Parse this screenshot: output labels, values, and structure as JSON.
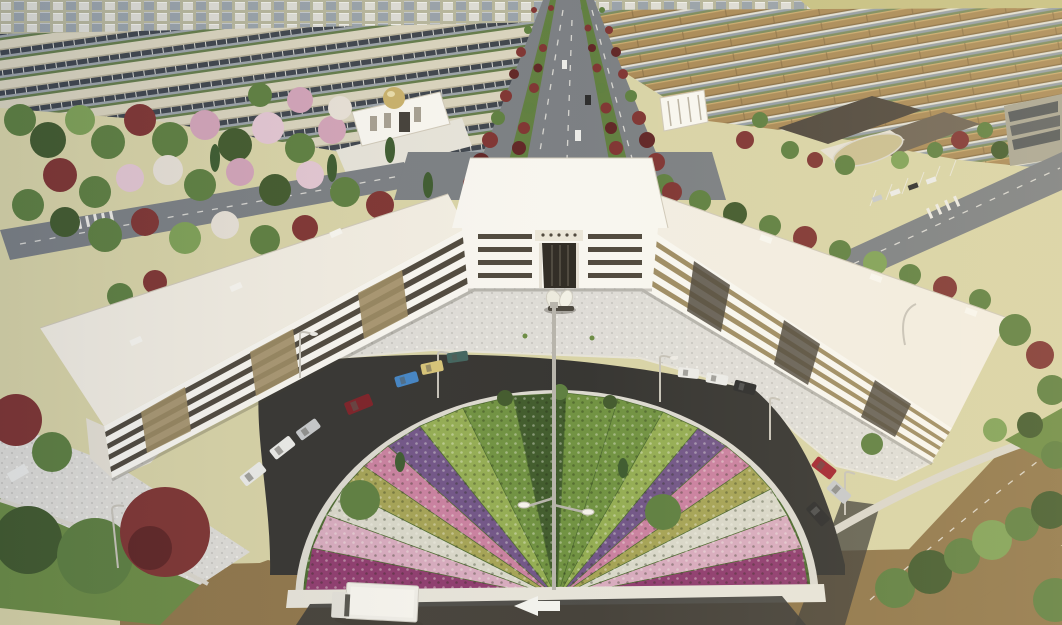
{
  "scene": {
    "type": "aerial-architectural-rendering",
    "description": "Aerial 3D architectural rendering of a white U-shaped office complex with a columned entrance pavilion, a speckled granite plaza with an abstract white sculpture, a dark ring road with parked cars, and a large semicircular ornamental garden of radial flower wedges around a high-mast light. A tree-lined boulevard leads into a master-planned district of row houses, a mosque with a gold dome, a campus with dark roofs, parks with green, red and pink trees, and a delivery truck on the foreground road with a white left-turn arrow.",
    "landmarks": {
      "main_building": "white U-shaped complex",
      "entrance_pavilion": "central entrance block with ornamental relief panel",
      "plaza": "speckled granite forecourt",
      "sculpture": "white abstract sculpture",
      "garden": "semicircular radial flower garden",
      "mast": "central high-mast light",
      "boulevard": "tree-lined central avenue",
      "mosque": "white mosque with gold dome",
      "truck": "white delivery truck",
      "arrow": "white road arrow pointing left"
    }
  },
  "palette": {
    "sky": "#d8d3a6",
    "field": "#c6c083",
    "cityBg": "#b6b59b",
    "cityLight": "#dddcd5",
    "citySlate": "#98a1a9",
    "roofBrown": "#a98956",
    "roofBrownDk": "#876c43",
    "houseFace": "#939ca6",
    "houseTrim": "#e3e0d8",
    "houseGap": "#7a8a5c",
    "wareRoof": "#d9d3bd",
    "wareWin": "#3d434b",
    "wareBase": "#9ba2a8",
    "wareGap": "#637a49",
    "roadGrey": "#7a7e82",
    "laneWhite": "#eceae4",
    "median": "#5f7e3e",
    "campusRoof": "#4e463c",
    "campusRoof2": "#6e6354",
    "campusCourt": "#c9bd90",
    "bldgWhite": "#f8f6f0",
    "bldgShade": "#e5e0d4",
    "bldgRoof": "#f2ede2",
    "bldgEdge": "#cfc8b8",
    "winDark": "#4e473c",
    "winTan": "#9d8b62",
    "portal": "#2e2a23",
    "ornament": "#ebe6d8",
    "plaza": "#dedcd7",
    "plazaDot1": "#cac8c3",
    "plazaDot2": "#eeece7",
    "asphalt": "#343330",
    "roadBrown": "#8f7549",
    "wetDark": "#3c3b37",
    "sidewalk": "#dad6cb",
    "gardenRim": "#dcd9d0",
    "stoneWhite": "#e6e3d9",
    "grass": "#6b8b43",
    "grassDk": "#4c6a30",
    "treeGreen": "#5d7e3f",
    "treeGreenDk": "#41592c",
    "treeGreenLt": "#7ea055",
    "cypress": "#3c5a2e",
    "treeRed": "#7e3331",
    "treeRedDk": "#5f2424",
    "treeRust": "#96452f",
    "treePink": "#d2a3b8",
    "treePinkLt": "#e3c6d2",
    "treeWhite": "#e7e0d6",
    "wMagenta": "#8e3a6e",
    "wPink": "#c97f9f",
    "wPinkLt": "#d7aabe",
    "wWhite": "#d8d7c9",
    "wOlive": "#a4a254",
    "wPurple": "#705486",
    "wGreenDk": "#3f5a2b",
    "wGreenMd": "#6f9140",
    "wGreenLt": "#93ac52",
    "carWhite": "#ebebe8",
    "carSilver": "#c6c8ca",
    "carRed": "#a3242f",
    "carMaroon": "#7c1f26",
    "carBlue": "#4284c4",
    "carYellow": "#d6c377",
    "carTeal": "#41635d",
    "carBlack": "#2b2b2b",
    "truckWhite": "#efede7",
    "truckDark": "#56534d",
    "arrowWhite": "#f2f2ee",
    "domeGold": "#c8b06a",
    "pole": "#c6c2b8",
    "mast": "#b7b4ab",
    "shadow": "#3c372d"
  }
}
